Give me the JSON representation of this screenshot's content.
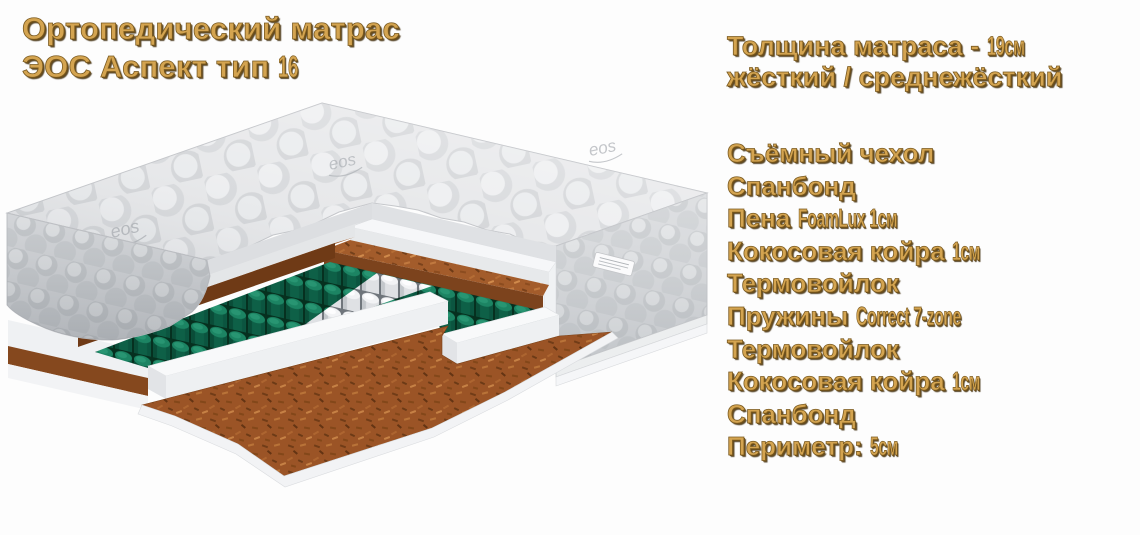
{
  "title": {
    "line1": "Ортопедический матрас",
    "line2_text": "ЭОС Аспект тип ",
    "line2_cond": "16"
  },
  "specs": {
    "thickness_line1_text": "Толщина матраса - ",
    "thickness_line1_cond": "19см",
    "thickness_line2": "жёсткий / среднежёсткий",
    "features": [
      {
        "text": "Съёмный чехол",
        "cond": ""
      },
      {
        "text": "Спанбонд",
        "cond": ""
      },
      {
        "text": "Пена ",
        "cond": "FoamLux 1см"
      },
      {
        "text": "Кокосовая койра ",
        "cond": "1см"
      },
      {
        "text": "Термовойлок",
        "cond": ""
      },
      {
        "text": "Пружины ",
        "cond": "Correct 7-zone"
      },
      {
        "text": "Термовойлок",
        "cond": ""
      },
      {
        "text": "Кокосовая койра ",
        "cond": "1см"
      },
      {
        "text": "Спанбонд",
        "cond": ""
      },
      {
        "text": "Периметр: ",
        "cond": "5см"
      }
    ]
  },
  "illustration": {
    "logo": "eos",
    "description": "Cutaway corner view of quilted mattress showing foam, coconut coir, thermo-felt and 7-zone pocket springs"
  },
  "colors": {
    "text_gold": "#d4a450",
    "text_shadow": "#3d2a0a",
    "quilt_gray": "#e6e7e9",
    "foam_white": "#f6f7f8",
    "coir_brown": "#a35c2b",
    "spring_green": "#0e6047",
    "spring_white": "#eceef0",
    "floor_brown": "#9b5426"
  }
}
